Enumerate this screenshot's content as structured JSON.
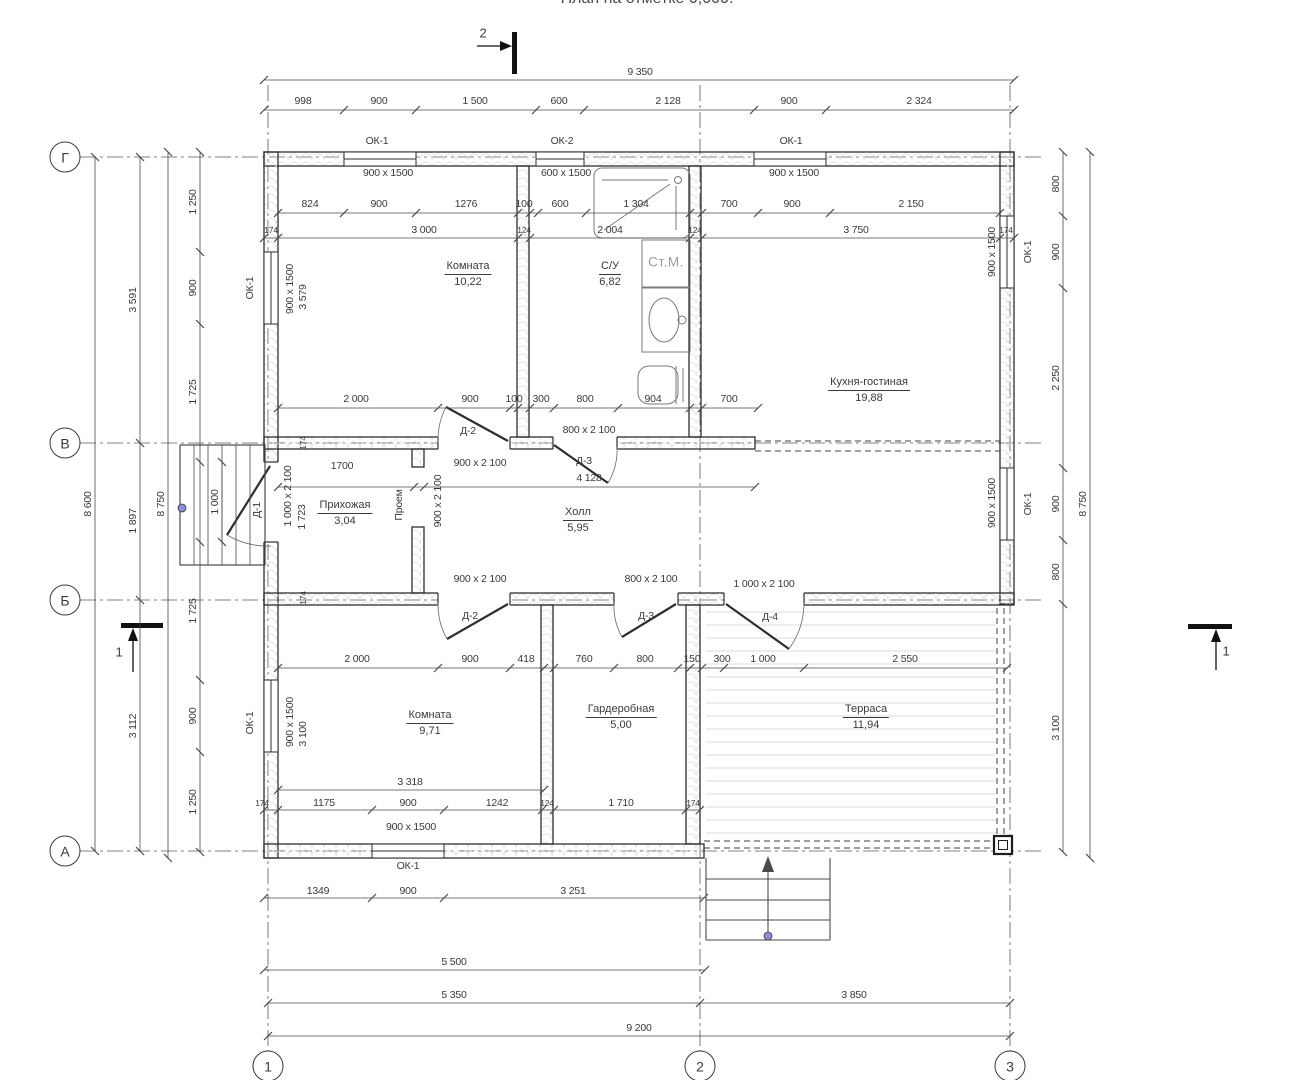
{
  "title": "План на отметке 0,000.",
  "colors": {
    "line": "#2e2e2e",
    "dim_line": "#4a4a4a",
    "wall_hatch": "#dcdcd8",
    "accent_dot": "#8b90d9",
    "gray_fixture_text": "#9c9c9c"
  },
  "axis_bubbles": [
    {
      "t": "Г",
      "x": 65,
      "y": 157
    },
    {
      "t": "В",
      "x": 65,
      "y": 443
    },
    {
      "t": "Б",
      "x": 65,
      "y": 600
    },
    {
      "t": "А",
      "x": 65,
      "y": 851
    },
    {
      "t": "1",
      "x": 268,
      "y": 1066
    },
    {
      "t": "2",
      "x": 700,
      "y": 1066
    },
    {
      "t": "3",
      "x": 1010,
      "y": 1066
    }
  ],
  "marker_labels": [
    {
      "t": "2",
      "x": 483,
      "y": 33
    },
    {
      "t": "1",
      "x": 119,
      "y": 652
    },
    {
      "t": "1",
      "x": 1226,
      "y": 651
    }
  ],
  "rooms": [
    {
      "name": "Комната",
      "area": "10,22",
      "x": 468,
      "y": 272
    },
    {
      "name": "С/У",
      "area": "6,82",
      "x": 610,
      "y": 272
    },
    {
      "name": "Кухня-гостиная",
      "area": "19,88",
      "x": 869,
      "y": 388
    },
    {
      "name": "Прихожая",
      "area": "3,04",
      "x": 345,
      "y": 511
    },
    {
      "name": "Холл",
      "area": "5,95",
      "x": 578,
      "y": 518
    },
    {
      "name": "Комната",
      "area": "9,71",
      "x": 430,
      "y": 721
    },
    {
      "name": "Гардеробная",
      "area": "5,00",
      "x": 621,
      "y": 715
    },
    {
      "name": "Терраса",
      "area": "11,94",
      "x": 866,
      "y": 715
    }
  ],
  "fixture_labels": [
    {
      "t": "Ст.М.",
      "x": 666,
      "y": 262
    }
  ],
  "window_tags": [
    {
      "t": "ОК-1",
      "x": 377,
      "y": 141
    },
    {
      "t": "ОК-2",
      "x": 562,
      "y": 141
    },
    {
      "t": "ОК-1",
      "x": 791,
      "y": 141
    },
    {
      "t": "ОК-1",
      "x": 250,
      "y": 288,
      "r": 1
    },
    {
      "t": "ОК-1",
      "x": 250,
      "y": 723,
      "r": 1
    },
    {
      "t": "ОК-1",
      "x": 1028,
      "y": 252,
      "r": 1
    },
    {
      "t": "ОК-1",
      "x": 1028,
      "y": 504,
      "r": 1
    },
    {
      "t": "ОК-1",
      "x": 408,
      "y": 866
    }
  ],
  "door_labels": [
    {
      "t": "Д-2",
      "x": 468,
      "y": 431
    },
    {
      "t": "Д-3",
      "x": 584,
      "y": 461
    },
    {
      "t": "Д-2",
      "x": 470,
      "y": 616
    },
    {
      "t": "Д-3",
      "x": 646,
      "y": 616
    },
    {
      "t": "Д-4",
      "x": 770,
      "y": 617
    },
    {
      "t": "Д-1",
      "x": 257,
      "y": 510,
      "r": 1
    },
    {
      "t": "Проем",
      "x": 399,
      "y": 505,
      "r": 1
    }
  ],
  "size_labels": [
    {
      "t": "900 x 1500",
      "x": 388,
      "y": 173
    },
    {
      "t": "600 x 1500",
      "x": 566,
      "y": 173
    },
    {
      "t": "900 x 1500",
      "x": 794,
      "y": 173
    },
    {
      "t": "800 x 2 100",
      "x": 589,
      "y": 430
    },
    {
      "t": "900 x 2 100",
      "x": 480,
      "y": 463
    },
    {
      "t": "900 x 2 100",
      "x": 480,
      "y": 579
    },
    {
      "t": "800 x 2 100",
      "x": 651,
      "y": 579
    },
    {
      "t": "1 000 x 2 100",
      "x": 764,
      "y": 584
    },
    {
      "t": "900 x 1500",
      "x": 411,
      "y": 827
    },
    {
      "t": "900 x 1500",
      "x": 290,
      "y": 289,
      "r": 1
    },
    {
      "t": "900 x 1500",
      "x": 290,
      "y": 722,
      "r": 1
    },
    {
      "t": "900 x 1500",
      "x": 992,
      "y": 252,
      "r": 1
    },
    {
      "t": "900 x 1500",
      "x": 992,
      "y": 503,
      "r": 1
    },
    {
      "t": "1 000 x 2 100",
      "x": 288,
      "y": 496,
      "r": 1
    },
    {
      "t": "900 x 2 100",
      "x": 438,
      "y": 501,
      "r": 1
    }
  ],
  "dim_labels": [
    {
      "t": "9 350",
      "x": 640,
      "y": 72
    },
    {
      "t": "998",
      "x": 303,
      "y": 101
    },
    {
      "t": "900",
      "x": 379,
      "y": 101
    },
    {
      "t": "1 500",
      "x": 475,
      "y": 101
    },
    {
      "t": "600",
      "x": 559,
      "y": 101
    },
    {
      "t": "2 128",
      "x": 668,
      "y": 101
    },
    {
      "t": "900",
      "x": 789,
      "y": 101
    },
    {
      "t": "2 324",
      "x": 919,
      "y": 101
    },
    {
      "t": "824",
      "x": 310,
      "y": 204
    },
    {
      "t": "900",
      "x": 379,
      "y": 204
    },
    {
      "t": "1276",
      "x": 466,
      "y": 204
    },
    {
      "t": "100",
      "x": 524,
      "y": 204
    },
    {
      "t": "600",
      "x": 560,
      "y": 204
    },
    {
      "t": "1 304",
      "x": 636,
      "y": 204
    },
    {
      "t": "700",
      "x": 729,
      "y": 204
    },
    {
      "t": "900",
      "x": 792,
      "y": 204
    },
    {
      "t": "2 150",
      "x": 911,
      "y": 204
    },
    {
      "t": "174",
      "x": 271,
      "y": 230,
      "s": 1
    },
    {
      "t": "3 000",
      "x": 424,
      "y": 230
    },
    {
      "t": "124",
      "x": 524,
      "y": 230,
      "s": 1
    },
    {
      "t": "2 004",
      "x": 610,
      "y": 230
    },
    {
      "t": "124",
      "x": 695,
      "y": 230,
      "s": 1
    },
    {
      "t": "3 750",
      "x": 856,
      "y": 230
    },
    {
      "t": "174",
      "x": 1006,
      "y": 230,
      "s": 1
    },
    {
      "t": "2 000",
      "x": 356,
      "y": 399
    },
    {
      "t": "900",
      "x": 470,
      "y": 399
    },
    {
      "t": "100",
      "x": 514,
      "y": 399
    },
    {
      "t": "300",
      "x": 541,
      "y": 399
    },
    {
      "t": "800",
      "x": 585,
      "y": 399
    },
    {
      "t": "904",
      "x": 653,
      "y": 399
    },
    {
      "t": "700",
      "x": 729,
      "y": 399
    },
    {
      "t": "1700",
      "x": 342,
      "y": 466
    },
    {
      "t": "4 128",
      "x": 589,
      "y": 478
    },
    {
      "t": "2 000",
      "x": 357,
      "y": 659
    },
    {
      "t": "900",
      "x": 470,
      "y": 659
    },
    {
      "t": "418",
      "x": 526,
      "y": 659
    },
    {
      "t": "760",
      "x": 584,
      "y": 659
    },
    {
      "t": "800",
      "x": 645,
      "y": 659
    },
    {
      "t": "150",
      "x": 692,
      "y": 659
    },
    {
      "t": "300",
      "x": 722,
      "y": 659
    },
    {
      "t": "1 000",
      "x": 763,
      "y": 659
    },
    {
      "t": "2 550",
      "x": 905,
      "y": 659
    },
    {
      "t": "3 318",
      "x": 410,
      "y": 782
    },
    {
      "t": "174",
      "x": 262,
      "y": 803,
      "s": 1
    },
    {
      "t": "1175",
      "x": 324,
      "y": 803
    },
    {
      "t": "900",
      "x": 408,
      "y": 803
    },
    {
      "t": "1242",
      "x": 497,
      "y": 803
    },
    {
      "t": "124",
      "x": 547,
      "y": 803,
      "s": 1
    },
    {
      "t": "1 710",
      "x": 621,
      "y": 803
    },
    {
      "t": "174",
      "x": 693,
      "y": 803,
      "s": 1
    },
    {
      "t": "1349",
      "x": 318,
      "y": 891
    },
    {
      "t": "900",
      "x": 408,
      "y": 891
    },
    {
      "t": "3 251",
      "x": 573,
      "y": 891
    },
    {
      "t": "5 500",
      "x": 454,
      "y": 962
    },
    {
      "t": "5 350",
      "x": 454,
      "y": 995
    },
    {
      "t": "3 850",
      "x": 854,
      "y": 995
    },
    {
      "t": "9 200",
      "x": 639,
      "y": 1028
    },
    {
      "t": "8 600",
      "x": 88,
      "y": 504,
      "r": 1
    },
    {
      "t": "3 591",
      "x": 133,
      "y": 300,
      "r": 1
    },
    {
      "t": "1 897",
      "x": 133,
      "y": 521,
      "r": 1
    },
    {
      "t": "3 112",
      "x": 133,
      "y": 726,
      "r": 1
    },
    {
      "t": "8 750",
      "x": 161,
      "y": 504,
      "r": 1
    },
    {
      "t": "1 250",
      "x": 193,
      "y": 202,
      "r": 1
    },
    {
      "t": "900",
      "x": 193,
      "y": 288,
      "r": 1
    },
    {
      "t": "1 725",
      "x": 193,
      "y": 392,
      "r": 1
    },
    {
      "t": "1 000",
      "x": 215,
      "y": 502,
      "r": 1
    },
    {
      "t": "1 725",
      "x": 193,
      "y": 611,
      "r": 1
    },
    {
      "t": "900",
      "x": 193,
      "y": 716,
      "r": 1
    },
    {
      "t": "1 250",
      "x": 193,
      "y": 802,
      "r": 1
    },
    {
      "t": "1 723",
      "x": 302,
      "y": 517,
      "r": 1
    },
    {
      "t": "3 579",
      "x": 303,
      "y": 297,
      "r": 1
    },
    {
      "t": "3 100",
      "x": 303,
      "y": 734,
      "r": 1
    },
    {
      "t": "174",
      "x": 303,
      "y": 443,
      "r": 1,
      "s": 1
    },
    {
      "t": "174",
      "x": 303,
      "y": 598,
      "r": 1,
      "s": 1
    },
    {
      "t": "800",
      "x": 1056,
      "y": 184,
      "r": 1
    },
    {
      "t": "900",
      "x": 1056,
      "y": 252,
      "r": 1
    },
    {
      "t": "2 250",
      "x": 1056,
      "y": 378,
      "r": 1
    },
    {
      "t": "900",
      "x": 1056,
      "y": 504,
      "r": 1
    },
    {
      "t": "800",
      "x": 1056,
      "y": 572,
      "r": 1
    },
    {
      "t": "3 100",
      "x": 1056,
      "y": 728,
      "r": 1
    },
    {
      "t": "8 750",
      "x": 1083,
      "y": 504,
      "r": 1
    }
  ]
}
